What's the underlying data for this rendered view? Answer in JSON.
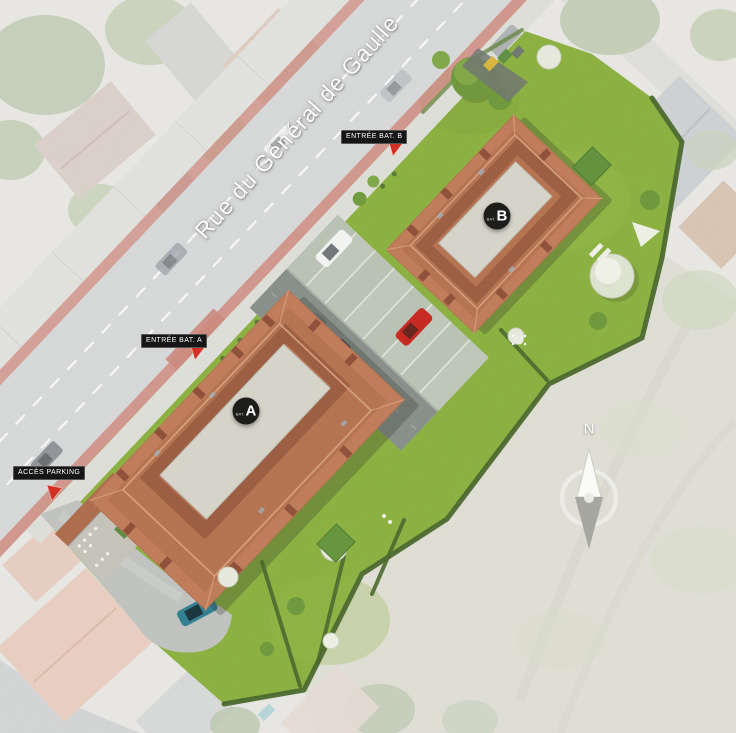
{
  "scene": {
    "street": {
      "name": "Rue du Général de Gaulle"
    },
    "markers": {
      "entrance_b": {
        "label": "ENTRÉE BAT. B"
      },
      "entrance_a": {
        "label": "ENTRÉE BAT. A"
      },
      "parking_access": {
        "label": "ACCÈS PARKING"
      }
    },
    "buildings": {
      "a": {
        "badge_prefix": "BAT.",
        "badge_letter": "A"
      },
      "b": {
        "badge_prefix": "BAT.",
        "badge_letter": "B"
      }
    },
    "compass": {
      "north": "N"
    },
    "colors": {
      "lawn": "#8ab13e",
      "hedge": "#49672b",
      "roof": "#b5714e",
      "roof_light": "#c4805d",
      "roof_dark": "#96573c",
      "ridge": "#d8a17e",
      "courtyard": "#d7d4ca",
      "road": "#d7d9da",
      "bike_lane": "#cc887c",
      "parking_aisle": "#878f8a",
      "parking_stalls": "#bfc7ba",
      "scrub": "#e3e2d8",
      "label_bg": "#161616",
      "label_text": "#ffffff",
      "arrow": "#d62b1f",
      "car_red": "#c8251d",
      "car_teal": "#2f7f90"
    }
  }
}
